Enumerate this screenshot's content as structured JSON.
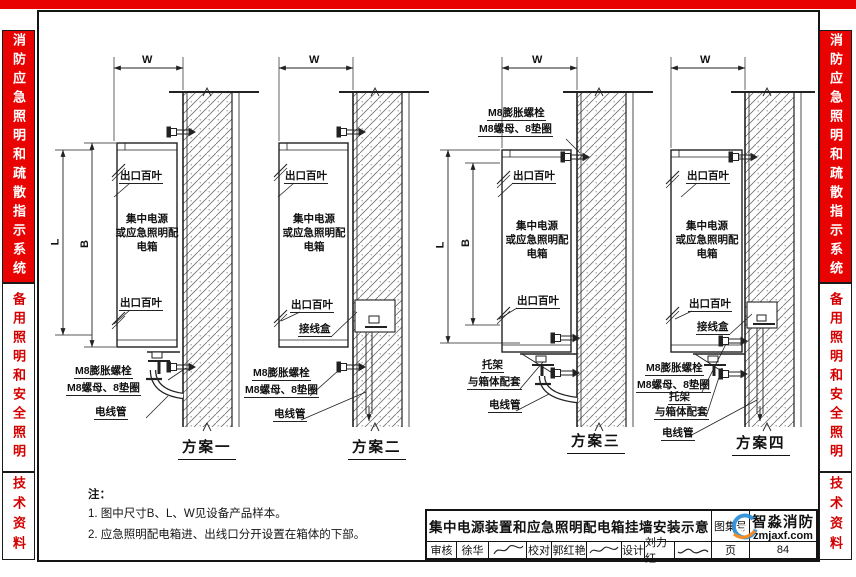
{
  "sidebar": {
    "system_title": "消防应急照明和疏散指示系统",
    "section_title": "备用照明和安全照明",
    "doc_type": "技术资料"
  },
  "dims": {
    "w": "W",
    "l": "L",
    "b": "B"
  },
  "labels": {
    "louver": "出口百叶",
    "box": "集中电源\n或应急照明配\n电箱",
    "junction_box": "接线盒",
    "expansion_bolt": "M8膨胀螺栓",
    "nut_washer": "M8螺母、8垫圈",
    "conduit": "电线管",
    "bracket": "托架",
    "bracket_match": "与箱体配套"
  },
  "schemes": [
    {
      "caption": "方案一"
    },
    {
      "caption": "方案二"
    },
    {
      "caption": "方案三"
    },
    {
      "caption": "方案四"
    }
  ],
  "notes": {
    "heading": "注：",
    "items": [
      "1. 图中尺寸B、L、W见设备产品样本。",
      "2. 应急照明配电箱进、出线口分开设置在箱体的下部。"
    ]
  },
  "titleblock": {
    "title": "集中电源装置和应急照明配电箱挂墙安装示意",
    "atlas_no_label": "图集号",
    "page_label": "页",
    "page_number": "84",
    "reviewer_label": "审核",
    "reviewer_name": "徐华",
    "proofreader_label": "校对",
    "proofreader_name": "郭红艳",
    "designer_label": "设计",
    "designer_name": "刘力红",
    "brand_name": "智淼消防",
    "brand_site": "zmjaxf.com"
  }
}
